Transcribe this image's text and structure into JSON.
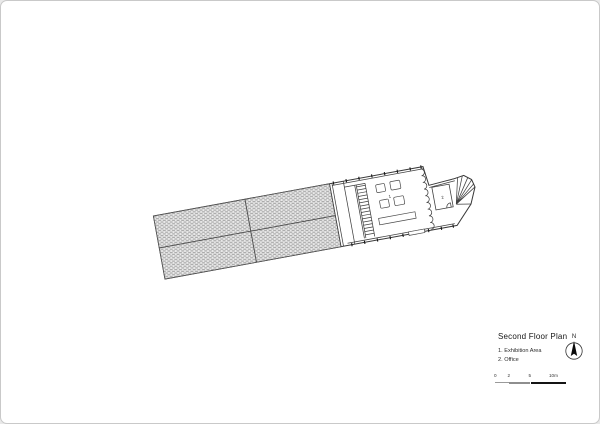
{
  "title_block": {
    "title": "Second Floor Plan",
    "legend": [
      "1. Exhibition Area",
      "2. Office"
    ]
  },
  "north": {
    "label": "N"
  },
  "scale_bar": {
    "labels": [
      "0",
      "2",
      "5",
      "10m"
    ]
  },
  "plan": {
    "room_labels": {
      "exhibition": "1",
      "office": "2"
    }
  },
  "icons": {
    "compass": "north-arrow-icon"
  },
  "colors": {
    "line": "#404040",
    "hatch_dash": "#a6a6a6",
    "hatch_bg": "#ebebeb",
    "scale_dark": "#141414",
    "scale_gray": "#8e8e8e",
    "page_border": "#c9c9c9"
  }
}
